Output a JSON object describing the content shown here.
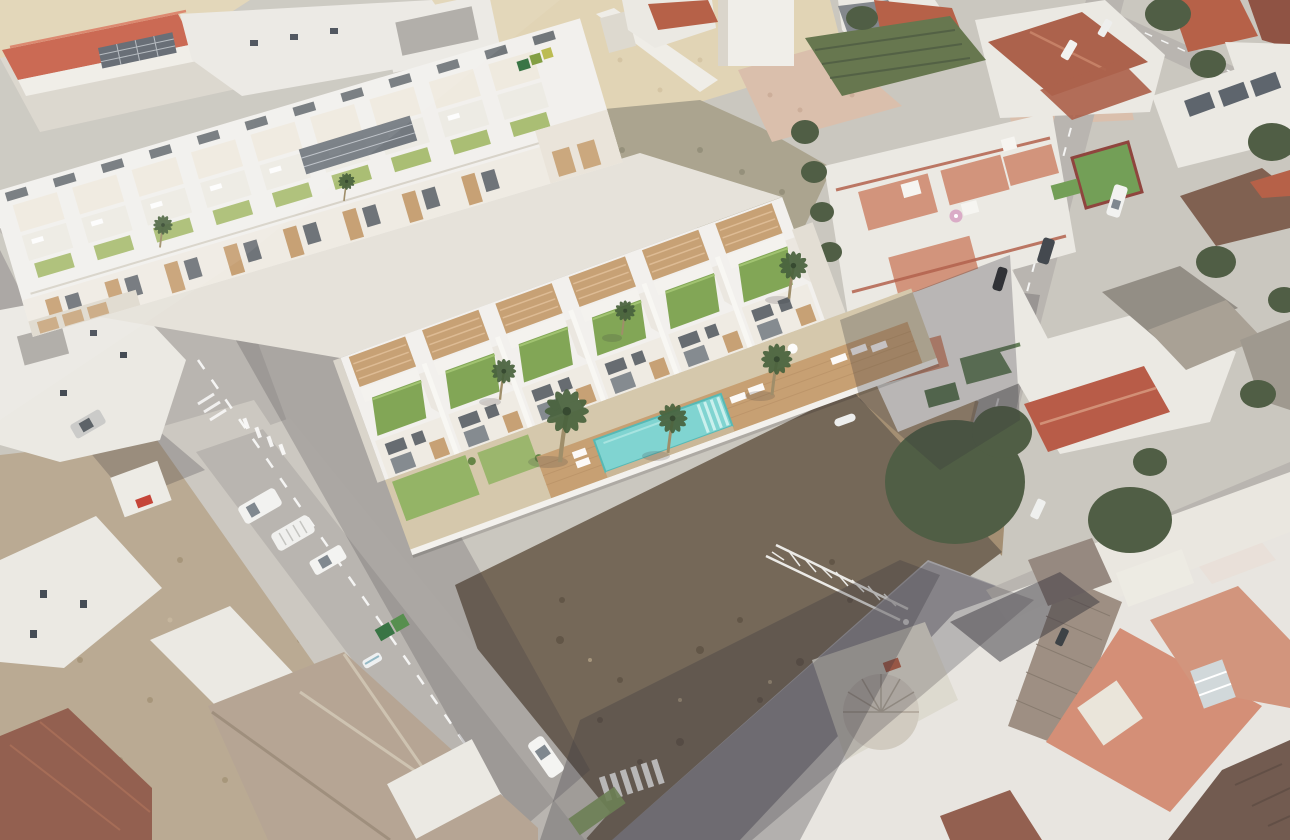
{
  "scene": {
    "description": "Aerial oblique view of a coastal Spanish town. A 3D architectural render of a new development of white two-storey townhouses is composited onto the photo: a rear block with rooftop pergola terraces and a front row of houses with sloped green grass roofs, timber pergolas, a shared timber sun deck, a turquoise communal swimming pool and palm trees. Around it are vacant dirt lots, a sandy scrub plot, streets with parked white vans and cars, green dumpsters, zebra crossings, a red-roofed warehouse at top left, and dense existing housing with terracotta, salmon and brown tiled roofs on the right and bottom of the frame.",
    "regions": [
      "new-development-rear-block",
      "new-development-front-row",
      "communal-garden-with-pool-and-deck",
      "vacant-dark-dirt-lot-foreground",
      "vacant-dirt-lot-left",
      "sandy-scrub-lots-top-center",
      "existing-town-right",
      "existing-town-bottom",
      "red-roof-warehouse-top-left",
      "street-grid-with-parked-vehicles"
    ],
    "objects": {
      "pool_count": 1,
      "zebra_crossings": 2,
      "green_dumpsters": 2,
      "recycling_bins_top": 3,
      "palm_trees_visible": 8,
      "white_vans_parked": 5,
      "white_cars_parked": 6,
      "dark_cars_parked": 3,
      "construction_truss": 1,
      "rooftop_pink_umbrella": 1
    }
  },
  "palette": {
    "base": "#c8c4bc",
    "road": "#b6b2ac",
    "roadPad": "#cac6be",
    "sand": "#e0d2b2",
    "scrub": "#a7a089",
    "pinkDirt": "#d8bca8",
    "orchard": "#5f7046",
    "dirtLot": "#b7a68e",
    "darkLot": "#6e6050",
    "lightDirt": "#a08a6c",
    "whiteWall": "#eae8e2",
    "grayRoof": "#a9a5a0",
    "renderWhite": "#f2f0ec",
    "renderShade": "#d8d3c9",
    "renderFacade": "#efeae2",
    "wood": "#c59c6e",
    "pergola": "#efe9de",
    "greenRoof": "#7ca24d",
    "lawn": "#8fb05e",
    "pool": "#7ad2cf",
    "poolEdge": "#4fb6b2",
    "deck": "#c49b6c",
    "palm": "#3f5a33",
    "treeDark": "#47563b",
    "tileRed": "#b3593f",
    "tileBrick": "#a85a43",
    "tileSalmon": "#cf8b70",
    "tileBrown": "#7a5948",
    "tileCheck": "#998a7d",
    "tileDark": "#6b5347",
    "tileCorner": "#8e5847",
    "paleRoof": "#b3a18f",
    "barnRed": "#c4573e",
    "marking": "#ffffff",
    "shadow": "#2f2b33",
    "carDark": "#3a4046",
    "binGreen": "#2f6e3b",
    "glass": "#565d66"
  }
}
